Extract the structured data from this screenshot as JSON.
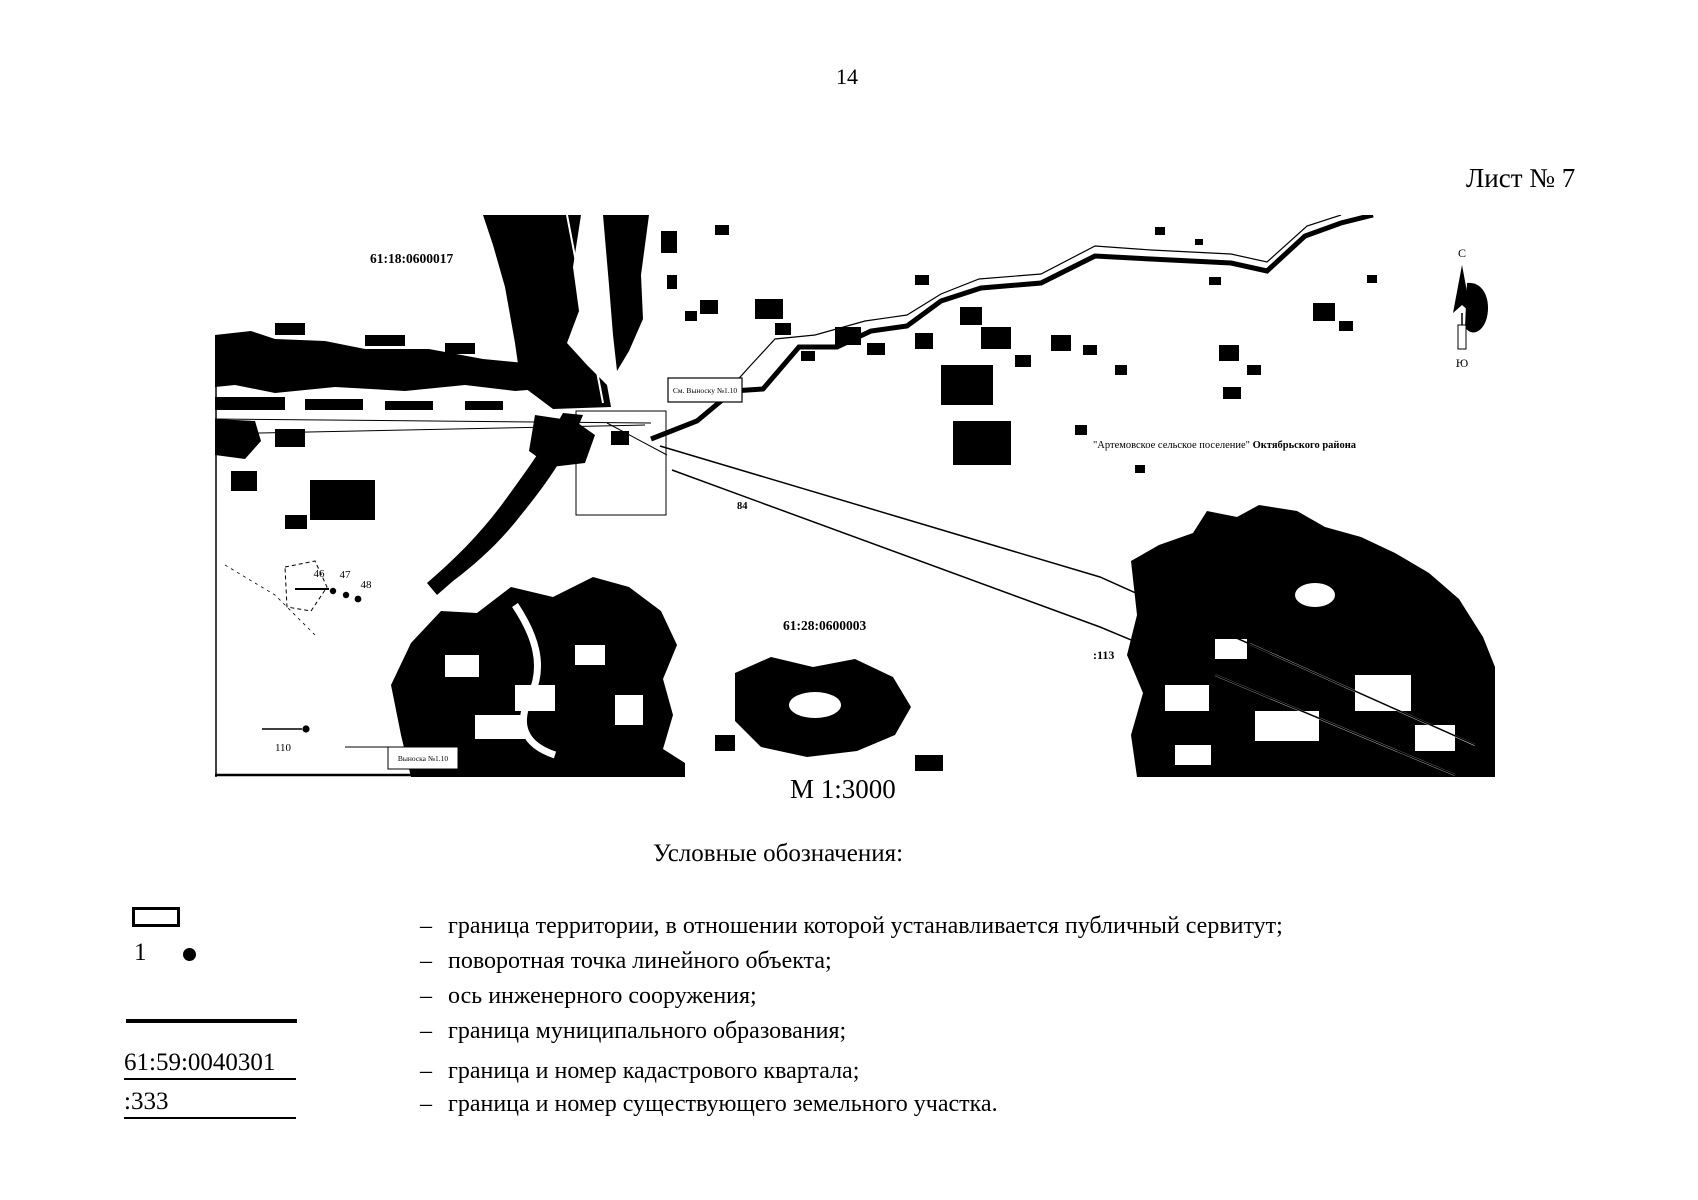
{
  "page": {
    "number": "14",
    "sheet_label": "Лист № 7"
  },
  "map": {
    "scale_label": "М 1:3000",
    "cadastral_quarter_top": "61:18:0600017",
    "cadastral_quarter_bottom": "61:28:0600003",
    "parcel_number": ":113",
    "point_84": "84",
    "point_110_junction": "110",
    "point_110_left": "110",
    "point_46": "46",
    "point_47": "47",
    "point_48": "48",
    "settlement_name": "\"Артемовское сельское поселение\"",
    "district_name": " Октябрьского района",
    "callout_reference": "См. Выноску №1.10",
    "callout_title": "Выноска №1.10",
    "compass": {
      "north": "С",
      "south": "Ю"
    }
  },
  "legend": {
    "title": "Условные обозначения:",
    "items": [
      {
        "dash": "–",
        "text": "граница территории, в отношении которой устанавливается публичный сервитут;"
      },
      {
        "dash": "–",
        "text": "поворотная точка линейного объекта;"
      },
      {
        "dash": "–",
        "text": "ось инженерного сооружения;"
      },
      {
        "dash": "–",
        "text": "граница муниципального образования;"
      },
      {
        "dash": "–",
        "text": "граница и номер кадастрового квартала;"
      },
      {
        "dash": "–",
        "text": "граница и номер существующего земельного участка."
      }
    ],
    "symbols": {
      "turn_point_number": "1",
      "cadastral_quarter_number": "61:59:0040301",
      "parcel_number": ":333"
    }
  },
  "colors": {
    "ink": "#000000",
    "paper": "#ffffff"
  }
}
